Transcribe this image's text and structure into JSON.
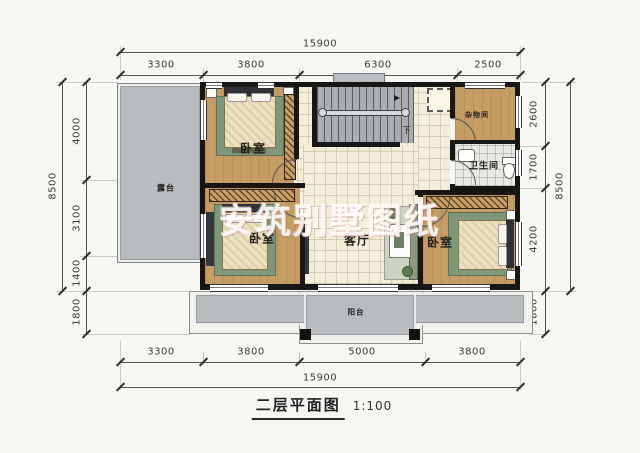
{
  "title": {
    "text": "二层平面图",
    "scale": "1:100"
  },
  "watermark": "安筑别墅图纸",
  "rooms": {
    "bedroom_top_left": "卧室",
    "bedroom_bottom_left": "卧室",
    "bedroom_bottom_right": "卧室",
    "living_room": "客厅",
    "bathroom": "卫生间",
    "storage": "杂物间",
    "terrace": "露台",
    "balcony": "阳台",
    "stairs_down": "下"
  },
  "dimensions": {
    "top_total": "15900",
    "top_segments": [
      "3300",
      "3800",
      "6300",
      "2500"
    ],
    "bottom_segments": [
      "3300",
      "3800",
      "5000",
      "3800"
    ],
    "bottom_total": "15900",
    "left_total": "8500",
    "left_segments": [
      "4000",
      "3100",
      "1400",
      "1800"
    ],
    "right_total": "8500",
    "right_segments": [
      "2600",
      "1700",
      "4200",
      "1800"
    ]
  },
  "colors": {
    "wall": "#181715",
    "wood_floor": "#c59c63",
    "tile_floor": "#f3eedb",
    "concrete": "#b8bcbe",
    "rug_green": "#7e9779",
    "background": "#f6f6f3"
  }
}
